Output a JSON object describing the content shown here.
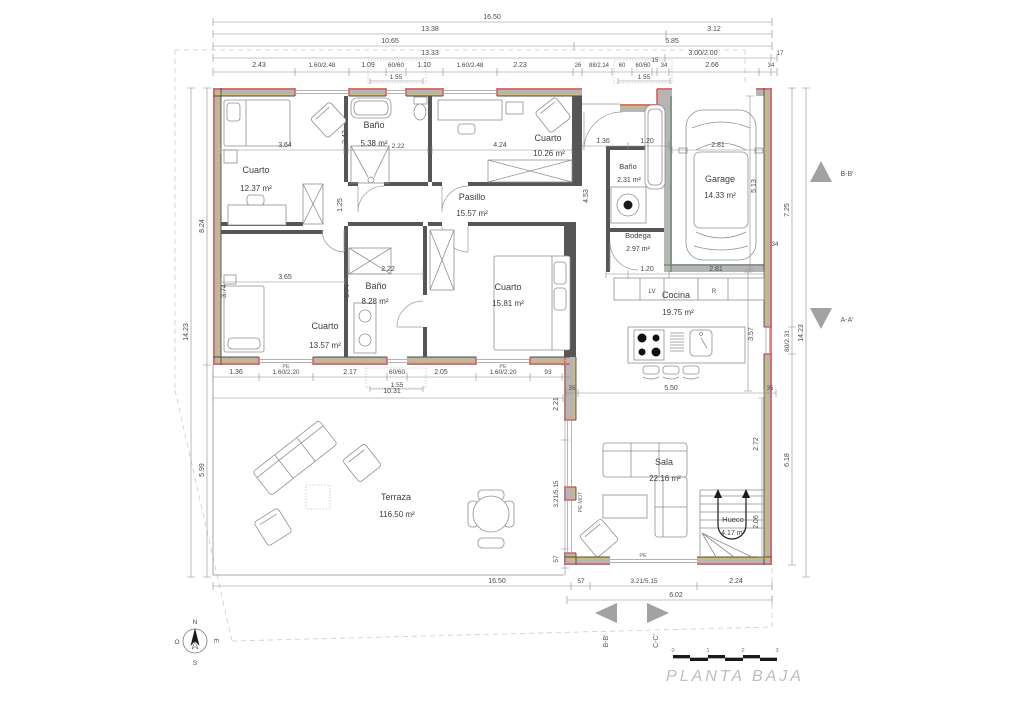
{
  "title": "PLANTA BAJA",
  "rooms": {
    "cuarto1": {
      "name": "Cuarto",
      "area": "12.37 m²"
    },
    "bano1": {
      "name": "Baño",
      "area": "5.38 m²"
    },
    "cuarto2": {
      "name": "Cuarto",
      "area": "10.26 m²"
    },
    "pasillo": {
      "name": "Pasillo",
      "area": "15.57 m²"
    },
    "cuarto3": {
      "name": "Cuarto",
      "area": "13.57 m²"
    },
    "bano2": {
      "name": "Baño",
      "area": "8.28 m²"
    },
    "cuarto4": {
      "name": "Cuarto",
      "area": "15.81 m²"
    },
    "bano3": {
      "name": "Baño",
      "area": "2.31 m²"
    },
    "bodega": {
      "name": "Bodega",
      "area": "2.97 m²"
    },
    "garage": {
      "name": "Garage",
      "area": "14.33 m²"
    },
    "cocina": {
      "name": "Cocina",
      "area": "19.75 m²"
    },
    "sala": {
      "name": "Sala",
      "area": "22.16 m²"
    },
    "hueco": {
      "name": "Hueco",
      "area": "4.17 m²"
    },
    "terraza": {
      "name": "Terraza",
      "area": "116.50 m²"
    }
  },
  "dims": {
    "t1": "16.50",
    "t2": "13.38",
    "t3": "3.12",
    "t4": "10.65",
    "t5": "5.85",
    "t6": "13.33",
    "t7": "3.00/2.00",
    "t8": "17",
    "d1": "2.43",
    "d2": "1.60/2.48",
    "d3": "1.09",
    "d4": "60/60",
    "d5": "1.10",
    "d6": "1.60/2.48",
    "d7": "2.23",
    "d8": "26",
    "d9": "88/2.14",
    "d10": "60",
    "d11": "60/60",
    "d12": "15",
    "d13": "34",
    "d14": "2.66",
    "d15": "34",
    "d16": "1.55",
    "d17": "1.55",
    "l1": "8.24",
    "l2": "14.23",
    "l3": "5.99",
    "r1": "5.13",
    "r2": "7.25",
    "r3": "34",
    "r4": "80/2.31",
    "r5": "35",
    "r6": "6.18",
    "r7": "14.23",
    "r8": "2.72",
    "r9": "2.06",
    "r10": "3.57",
    "i1": "3.64",
    "i2": "2.43",
    "i3": "2.22",
    "i4": "4.24",
    "i5": "1.25",
    "i6": "3.65",
    "i7": "3.74",
    "i8": "3.74",
    "i9": "2.22",
    "i10": "4.53",
    "i11": "1.36",
    "i12": "1.20",
    "i13": "2.81",
    "i14": "1.20",
    "i15": "2.81",
    "i16": "5.50",
    "i17": "35",
    "b1": "1.36",
    "b2": "1.60/2.20",
    "b3": "2.17",
    "b4": "60/60",
    "b5": "1.55",
    "b6": "2.05",
    "b7": "1.60/2.20",
    "b8": "93",
    "b9": "10.31",
    "e1": "2.21",
    "e2": "3.21/5.15",
    "e3": "57",
    "f1": "16.50",
    "f2": "57",
    "f3": "3.21/5.15",
    "f4": "2.24",
    "f5": "6.02"
  },
  "labels": {
    "pe": "PE",
    "pe_mot": "PE MOT",
    "lv": "LV",
    "r": "R"
  },
  "sections": {
    "bb": "B-B'",
    "aa": "A-A'",
    "cc": "C-C'"
  },
  "compass": {
    "n": "N",
    "s": "S",
    "e": "E",
    "o": "O"
  },
  "scalebar": {
    "s0": "0",
    "s1": "1",
    "s2": "2",
    "s3": "3"
  },
  "colors": {
    "wall_fill": "#b5b5b5",
    "exterior_line": "#e05c5c",
    "insulation": "#eec119",
    "interior_line": "#4c4c4c",
    "dim_text": "#4a4a4a",
    "title": "#bdbdbd"
  }
}
